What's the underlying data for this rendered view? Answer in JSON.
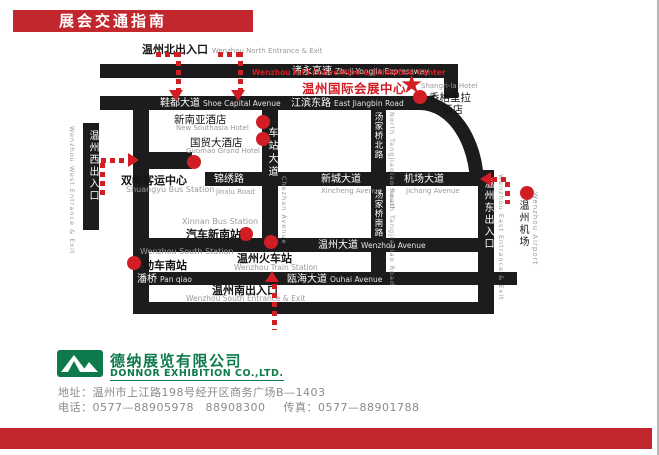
{
  "colors": {
    "banner_red": "#C1272D",
    "map_red": "#D01E24",
    "road": "#1C1C1C",
    "green": "#0E7A4C",
    "gray": "#8C8C8C"
  },
  "icons": {
    "star": "★"
  },
  "banner": {
    "title": "展会交通指南"
  },
  "map": {
    "entrances": {
      "north": {
        "zh": "温州北出入口",
        "en": "Wenzhou North Entrance & Exit"
      },
      "west": {
        "zh": "温州西出入口",
        "en": "Wenzhou West Entrance & Exit"
      },
      "south": {
        "zh": "温州南出入口",
        "en": "Wenzhou South Entrance & Exit"
      },
      "east": {
        "zh": "温州东出入口",
        "en": "Wenzhou East Entrance & Exit"
      }
    },
    "center": {
      "en": "Wenzhou Int'l Convention & Exhibition Center",
      "zh": "温州国际会展中心"
    },
    "roads": {
      "expressway": {
        "zh": "诸永高速",
        "en": "Zhuji-Yongjia Expressway"
      },
      "shoe_capital": {
        "zh": "鞋都大道",
        "en": "Shoe Capital Avenue"
      },
      "jiangbin": {
        "zh": "江滨东路",
        "en": "East Jiangbin Road"
      },
      "jinxiu": {
        "zh": "锦绣路",
        "en": "Jinxiu Road"
      },
      "xincheng": {
        "zh": "新城大道",
        "en": "Xincheng Avenue"
      },
      "jichang": {
        "zh": "机场大道",
        "en": "Jichang Avenue"
      },
      "chezhan": {
        "zh": "车站大道",
        "en": "Chezhan Avenue"
      },
      "tangjiaqiao_north": {
        "zh": "汤家桥北路",
        "en": "North Tangjiaqiao Road"
      },
      "tangjiaqiao_south": {
        "zh": "汤家桥南路",
        "en": "South Tangjiaqiao Road"
      },
      "wenzhou_ave": {
        "zh": "温州大道",
        "en": "Wenzhou Avenue"
      },
      "panqiao": {
        "zh": "潘桥",
        "en": "Pan qiao"
      },
      "ouhai": {
        "zh": "瓯海大道",
        "en": "Ouhai Avenue"
      }
    },
    "pois": {
      "shangri_la": {
        "en": "Shangri-la Hotel",
        "zh_line1": "香格里拉",
        "zh_line2": "酒店"
      },
      "new_southasia": {
        "zh": "新南亚酒店",
        "en": "New Southasia Hotel"
      },
      "guomao": {
        "zh": "国贸大酒店",
        "en": "Guomao Grand Hotel"
      },
      "shuangyu": {
        "zh": "双屿客运中心",
        "en": "Shuangyu Bus Station"
      },
      "xinnan": {
        "zh": "汽车新南站",
        "en": "Xinnan Bus Station"
      },
      "south_station": {
        "zh": "动车南站",
        "en": "Wenzhou South Station"
      },
      "train_station": {
        "zh": "温州火车站",
        "en": "Wenzhou Train Station"
      },
      "airport": {
        "zh": "温州机场",
        "en": "Wenzhou Airport"
      }
    }
  },
  "footer": {
    "company_zh": "德纳展览有限公司",
    "company_en": "DONNOR EXHIBITION CO.,LTD.",
    "address": "地址：温州市上江路198号经开区商务广场B—1403",
    "phone": "电话：0577—88905978　88908300",
    "fax": "传真：0577—88901788"
  }
}
